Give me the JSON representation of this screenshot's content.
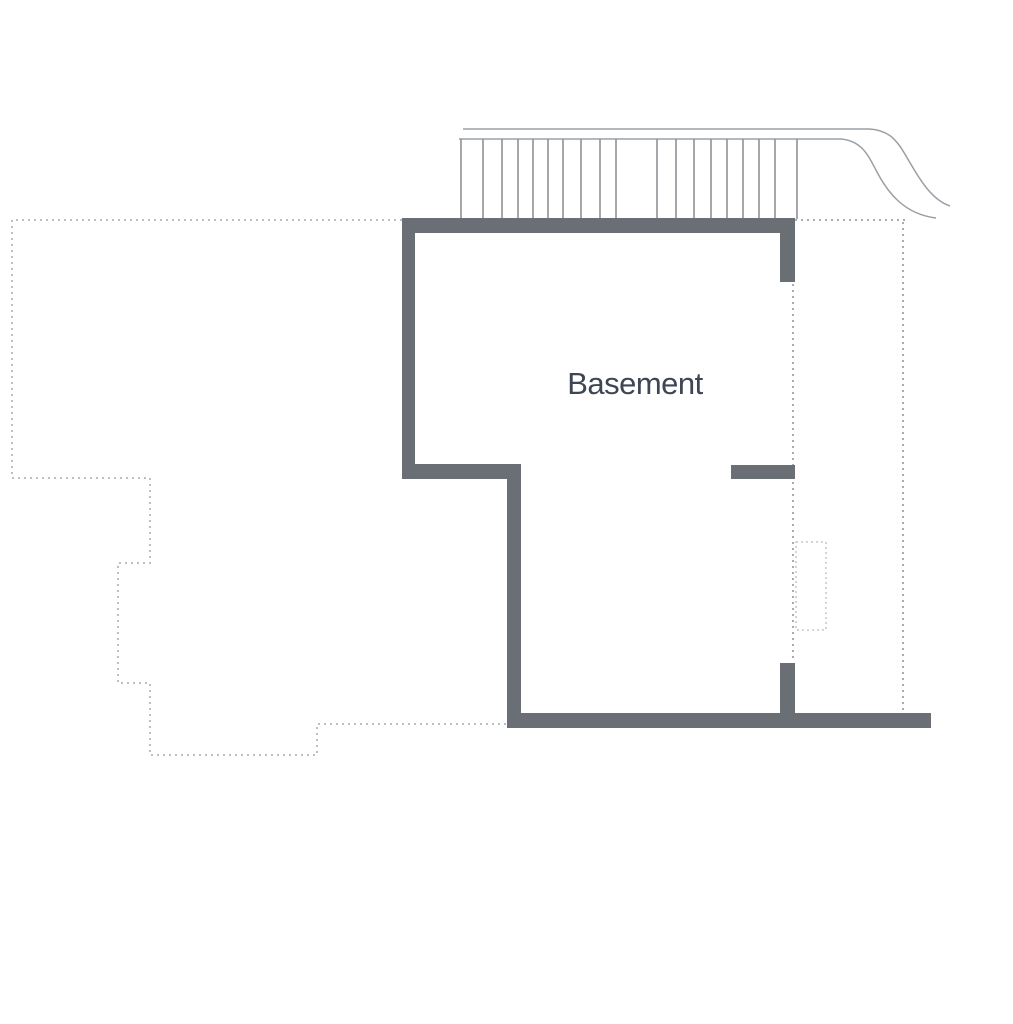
{
  "page": {
    "background": "#ffffff"
  },
  "plan": {
    "room_label": "Basement",
    "colors": {
      "wall": "#6a6f75",
      "stair_line": "#8d9297",
      "rail_line": "#9aa0a5",
      "dotted_light": "#bcc0c2",
      "dotted_medium": "#a8adb1",
      "well_outline": "#c3c7c9",
      "label_text": "#3e4655"
    },
    "stairs": {
      "tread_xs": [
        461,
        483,
        502,
        518,
        533,
        548,
        563,
        581,
        600,
        616,
        657,
        676,
        694,
        711,
        727,
        743,
        759,
        775,
        797
      ],
      "top_y": 139,
      "bottom_y": 219
    }
  }
}
